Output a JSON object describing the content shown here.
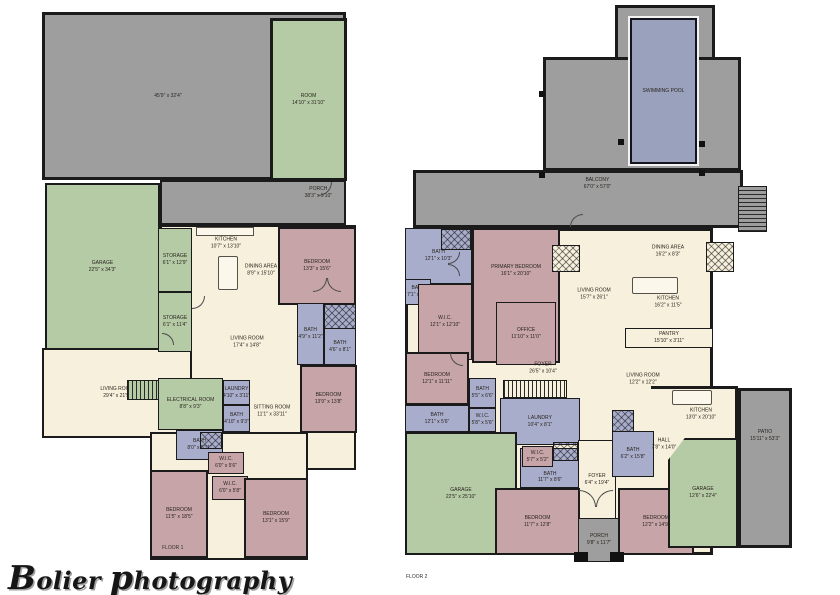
{
  "watermark": {
    "word1": "Bolier",
    "word2": "photography"
  },
  "colors": {
    "wall": "#1b1b1b",
    "outdoor_gray": "#9e9e9e",
    "room_green": "#b5cba6",
    "floor_cream": "#f7f0dc",
    "bedroom_mauve": "#c6a4a8",
    "bath_blue": "#a8adcc",
    "pool_blue": "#99a1bd"
  },
  "floor1": {
    "caption": "FLOOR 1",
    "rooms": [
      {
        "name": "",
        "dims": "45'9\" x 32'4\""
      },
      {
        "name": "ROOM",
        "dims": "14'10\" x 31'10\""
      },
      {
        "name": "PORCH",
        "dims": "38'3\" x 9'10\""
      },
      {
        "name": "GARAGE",
        "dims": "22'5\" x 34'3\""
      },
      {
        "name": "STORAGE",
        "dims": "6'1\" x 12'9\""
      },
      {
        "name": "STORAGE",
        "dims": "6'1\" x 11'4\""
      },
      {
        "name": "KITCHEN",
        "dims": "10'7\" x 13'10\""
      },
      {
        "name": "DINING AREA",
        "dims": "8'9\" x 15'10\""
      },
      {
        "name": "BEDROOM",
        "dims": "13'3\" x 15'6\""
      },
      {
        "name": "LIVING ROOM",
        "dims": "17'4\" x 14'8\""
      },
      {
        "name": "BATH",
        "dims": "4'9\" x 11'2\""
      },
      {
        "name": "BATH",
        "dims": "4'6\" x 8'1\""
      },
      {
        "name": "LIVING ROOM",
        "dims": "29'4\" x 21'9\""
      },
      {
        "name": "ELECTRICAL ROOM",
        "dims": "8'8\" x 9'3\""
      },
      {
        "name": "LAUNDRY",
        "dims": "4'10\" x 3'11\""
      },
      {
        "name": "BATH",
        "dims": "4'10\" x 9'3\""
      },
      {
        "name": "BATH",
        "dims": "8'0\" x 5'11\""
      },
      {
        "name": "W.I.C.",
        "dims": "6'0\" x 5'6\""
      },
      {
        "name": "W.I.C.",
        "dims": "6'0\" x 5'8\""
      },
      {
        "name": "SITTING ROOM",
        "dims": "11'1\" x 33'11\""
      },
      {
        "name": "BEDROOM",
        "dims": "13'9\" x 13'8\""
      },
      {
        "name": "BEDROOM",
        "dims": "11'5\" x 18'5\""
      },
      {
        "name": "BEDROOM",
        "dims": "13'1\" x 15'9\""
      }
    ]
  },
  "floor2": {
    "caption": "FLOOR 2",
    "rooms": [
      {
        "name": "SWIMMING POOL",
        "dims": ""
      },
      {
        "name": "BALCONY",
        "dims": "67'0\" x 57'0\""
      },
      {
        "name": "BATH",
        "dims": "12'1\" x 10'3\""
      },
      {
        "name": "BATH",
        "dims": "7'1\" x 5'4\""
      },
      {
        "name": "PRIMARY BEDROOM",
        "dims": "16'1\" x 20'10\""
      },
      {
        "name": "OFFICE",
        "dims": "11'10\" x 11'0\""
      },
      {
        "name": "W.I.C.",
        "dims": "12'1\" x 12'10\""
      },
      {
        "name": "DINING AREA",
        "dims": "16'2\" x 8'3\""
      },
      {
        "name": "LIVING ROOM",
        "dims": "15'7\" x 26'1\""
      },
      {
        "name": "KITCHEN",
        "dims": "16'2\" x 11'5\""
      },
      {
        "name": "PANTRY",
        "dims": "15'10\" x 3'11\""
      },
      {
        "name": "FOYER",
        "dims": "26'5\" x 10'4\""
      },
      {
        "name": "BEDROOM",
        "dims": "12'1\" x 11'11\""
      },
      {
        "name": "BATH",
        "dims": "5'5\" x 6'6\""
      },
      {
        "name": "BATH",
        "dims": "12'1\" x 5'6\""
      },
      {
        "name": "W.I.C.",
        "dims": "5'8\" x 5'6\""
      },
      {
        "name": "LAUNDRY",
        "dims": "10'4\" x 8'1\""
      },
      {
        "name": "LIVING ROOM",
        "dims": "12'2\" x 12'2\""
      },
      {
        "name": "KITCHEN",
        "dims": "13'0\" x 20'10\""
      },
      {
        "name": "HALL",
        "dims": "7'8\" x 14'0\""
      },
      {
        "name": "BATH",
        "dims": "6'2\" x 15'8\""
      },
      {
        "name": "GARAGE",
        "dims": "22'5\" x 25'10\""
      },
      {
        "name": "W.I.C.",
        "dims": "5'7\" x 5'2\""
      },
      {
        "name": "BATH",
        "dims": "11'7\" x 8'6\""
      },
      {
        "name": "FOYER",
        "dims": "6'4\" x 19'4\""
      },
      {
        "name": "BEDROOM",
        "dims": "11'7\" x 12'8\""
      },
      {
        "name": "BEDROOM",
        "dims": "12'2\" x 14'9\""
      },
      {
        "name": "PORCH",
        "dims": "9'8\" x 11'7\""
      },
      {
        "name": "GARAGE",
        "dims": "12'6\" x 22'4\""
      },
      {
        "name": "PATIO",
        "dims": "15'11\" x 53'3\""
      }
    ]
  }
}
